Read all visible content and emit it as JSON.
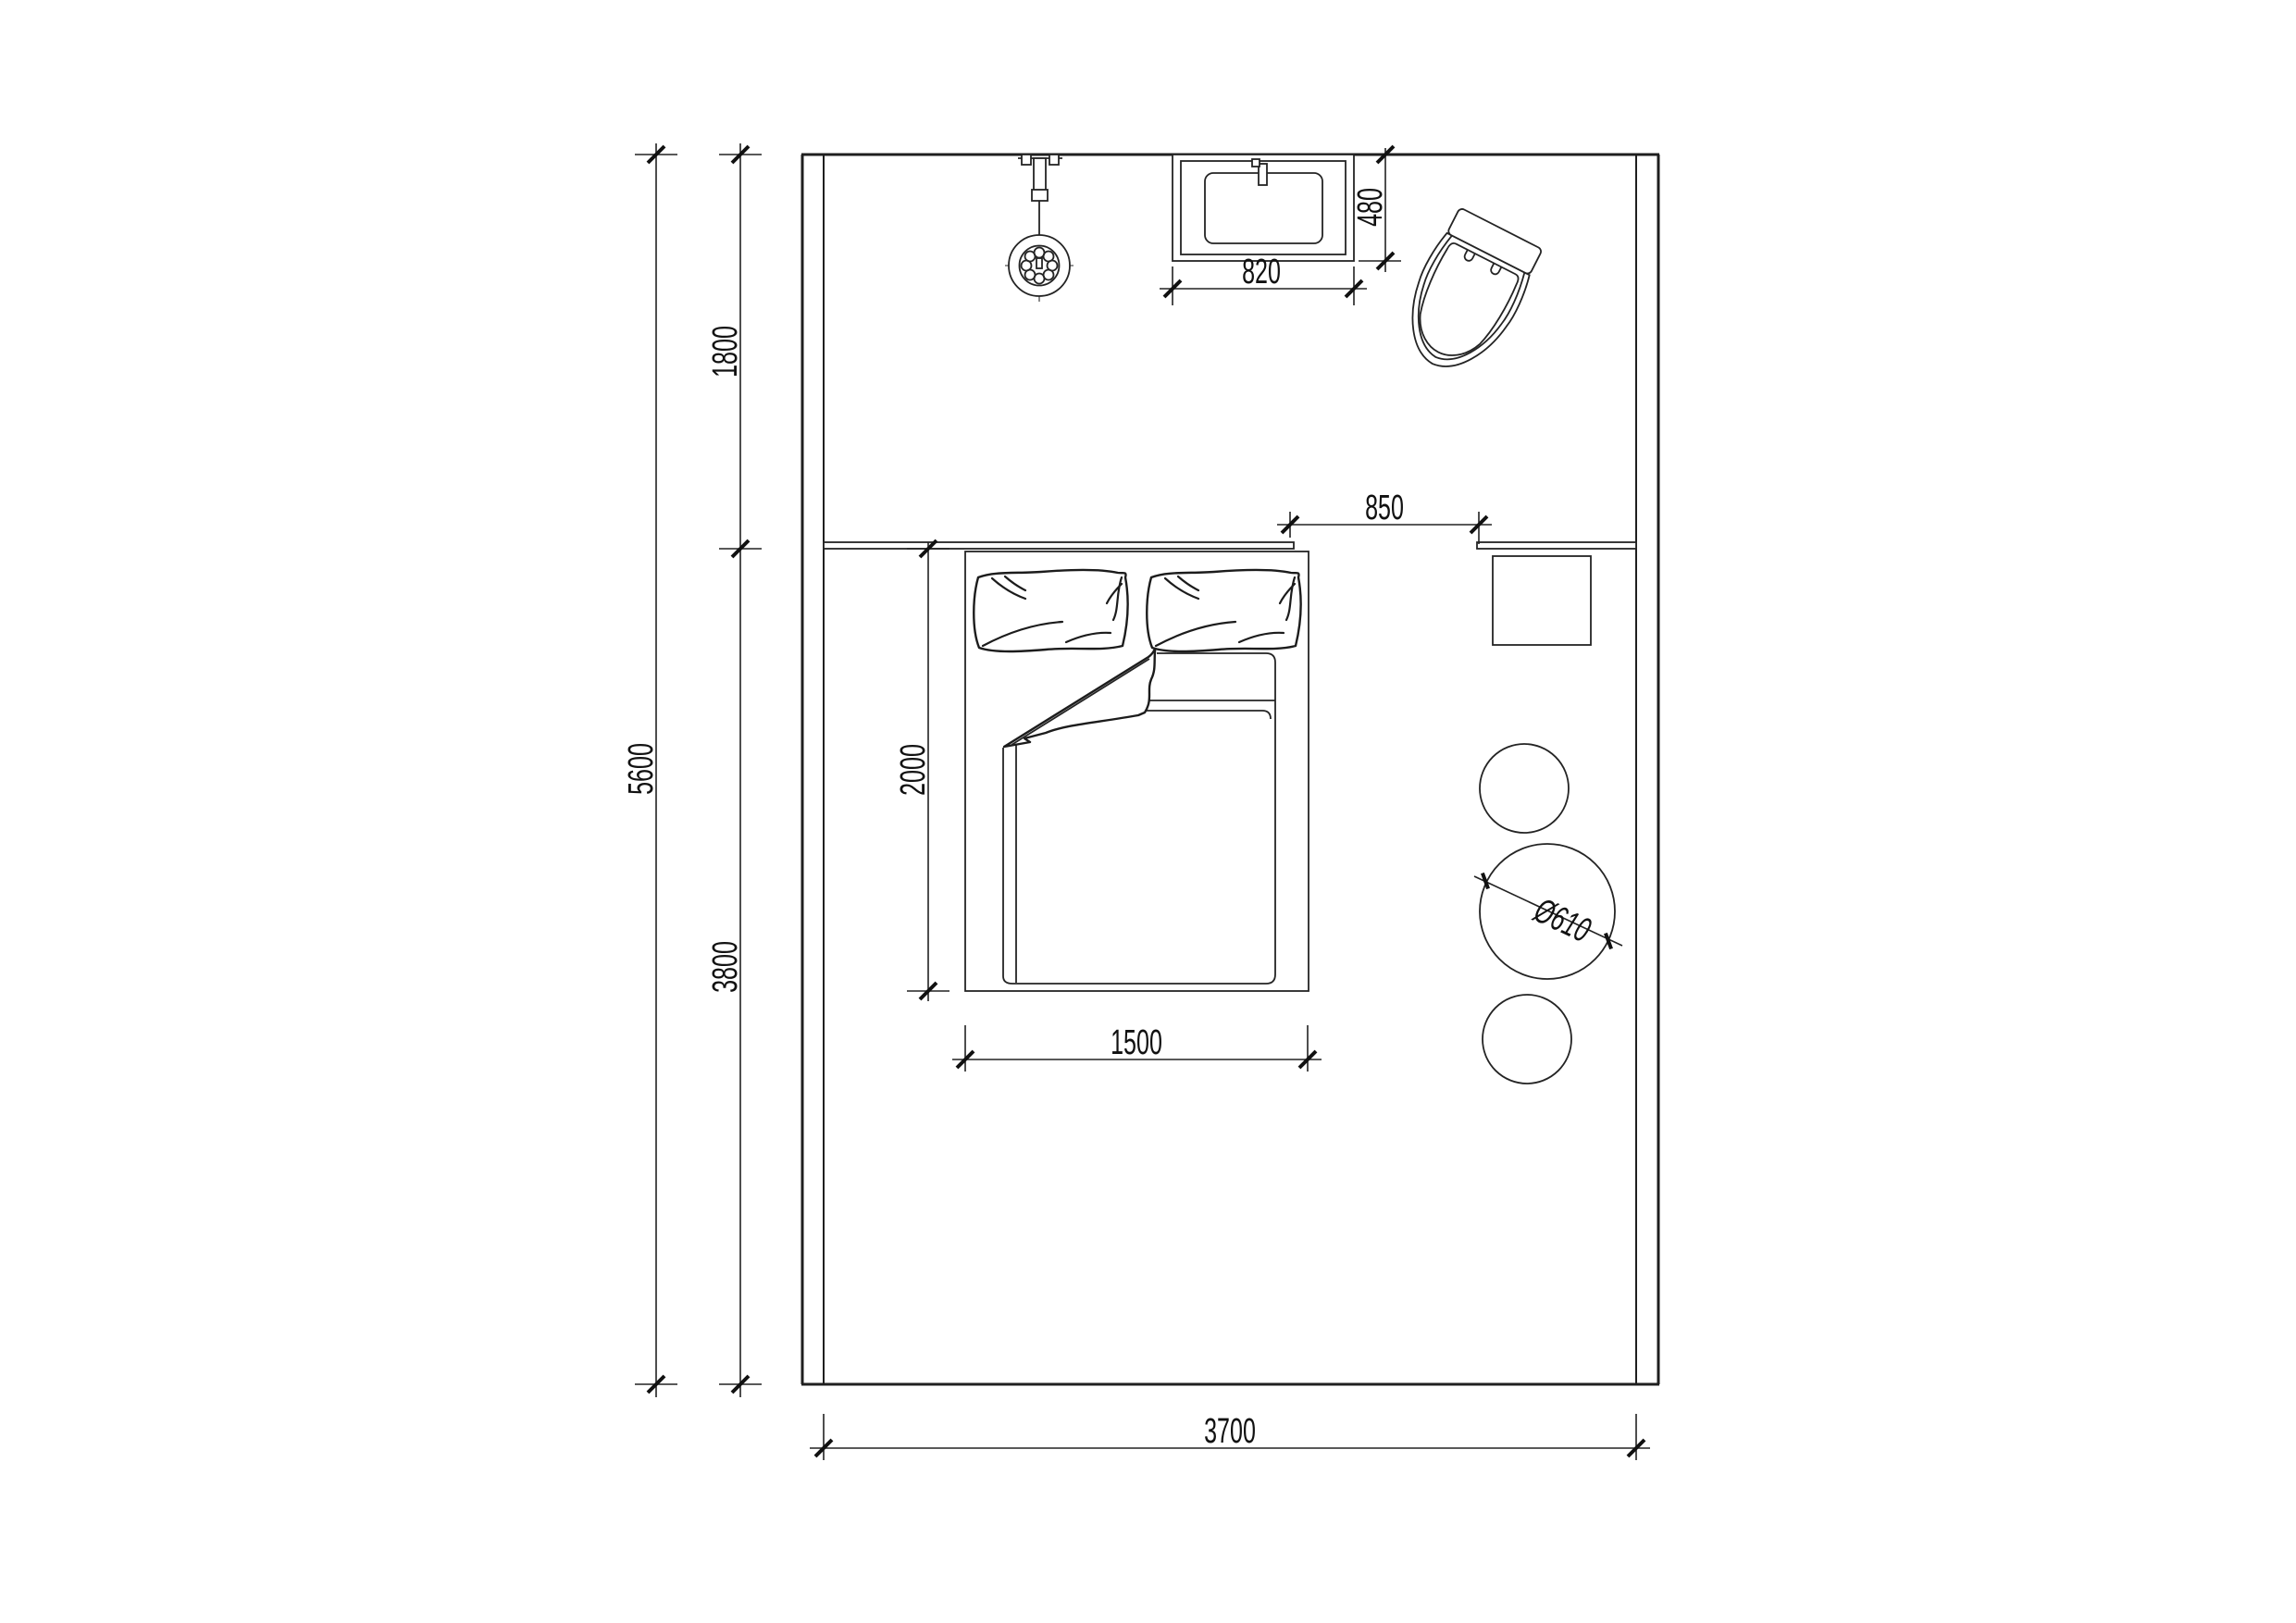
{
  "page": {
    "background": "#ffffff",
    "kind": "architectural-floor-plan"
  },
  "drawing": {
    "line_color": "#222222",
    "text_color": "#111111",
    "room": {
      "interior_width_label": "3700",
      "interior_height_label": "5600"
    },
    "dimensions": {
      "total_height": {
        "label": "5600",
        "orientation": "vertical"
      },
      "bath_depth": {
        "label": "1800",
        "orientation": "vertical"
      },
      "bedroom_depth": {
        "label": "3800",
        "orientation": "vertical"
      },
      "room_width": {
        "label": "3700",
        "orientation": "horizontal"
      },
      "bed_length": {
        "label": "2000",
        "orientation": "vertical"
      },
      "bed_width": {
        "label": "1500",
        "orientation": "horizontal"
      },
      "opening_width": {
        "label": "850",
        "orientation": "horizontal"
      },
      "basin_width": {
        "label": "820",
        "orientation": "horizontal"
      },
      "basin_depth": {
        "label": "480",
        "orientation": "vertical"
      },
      "table_diameter": {
        "label": "Ø610",
        "orientation": "diagonal"
      }
    },
    "furniture": {
      "shower": "hand-shower-on-rail",
      "basin": "washbasin-counter",
      "toilet": "toilet",
      "ledge": "headboard-ledge",
      "bed": "double-bed-with-pillows-and-duvet",
      "cabinet": "square-side-cabinet",
      "stool_top": "round-stool",
      "table": "round-table",
      "stool_bottom": "round-stool"
    }
  }
}
